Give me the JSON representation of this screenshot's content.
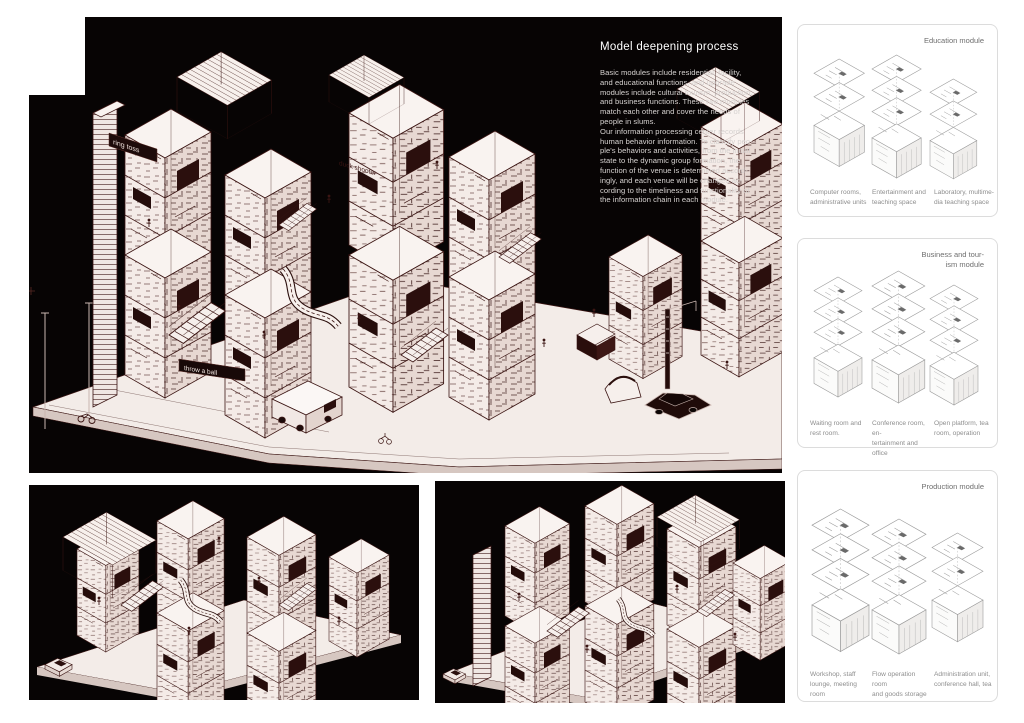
{
  "main_panel": {
    "title": "Model deepening process",
    "body": "Basic modules include residential, facility,\nand educational functions, and upgrade\nmodules include cultural tourism, production,\nand business functions. These two modules\nmatch each other and cover the needs of\npeople in slums.\nOur information processing center records\nhuman behavior information. To classify peo-\nple's behaviors and activities, from the initial\nstate to the dynamic group formation, the\nfunction of the venue is determined accord-\ningly, and each venue will be changed ac-\ncording to the timeliness and functionality of\nthe information chain in each module.",
    "signs": {
      "ring_toss": "ring toss",
      "throw_a_ball": "throw a ball",
      "duck_shooter": "duck shooter"
    }
  },
  "modules": [
    {
      "title": "Education module",
      "captions": [
        "Computer rooms,\nadministrative units",
        "Entertainment and\nteaching space",
        "Laboratory, multime-\ndia teaching space"
      ]
    },
    {
      "title": "Business and tour-\nism module",
      "captions": [
        "Waiting room and\nrest room.",
        "Conference room, en-\ntertainment and office",
        "Open platform, tea\nroom, operation"
      ]
    },
    {
      "title": "Production module",
      "captions": [
        "Workshop, staff\nlounge, meeting room",
        "Flow operation room\nand goods storage",
        "Administration unit,\nconference hall, tea"
      ]
    }
  ],
  "colors": {
    "panel_bg": "#070404",
    "drawing_ink": "#3b1513",
    "drawing_dark_fill": "#2b0f0d",
    "drawing_paper": "#f7f0ec",
    "card_border": "#dcdcdc",
    "card_title_text": "#6e6e6e",
    "caption_text": "#8e8e8e",
    "body_text": "#d6d2d0"
  }
}
